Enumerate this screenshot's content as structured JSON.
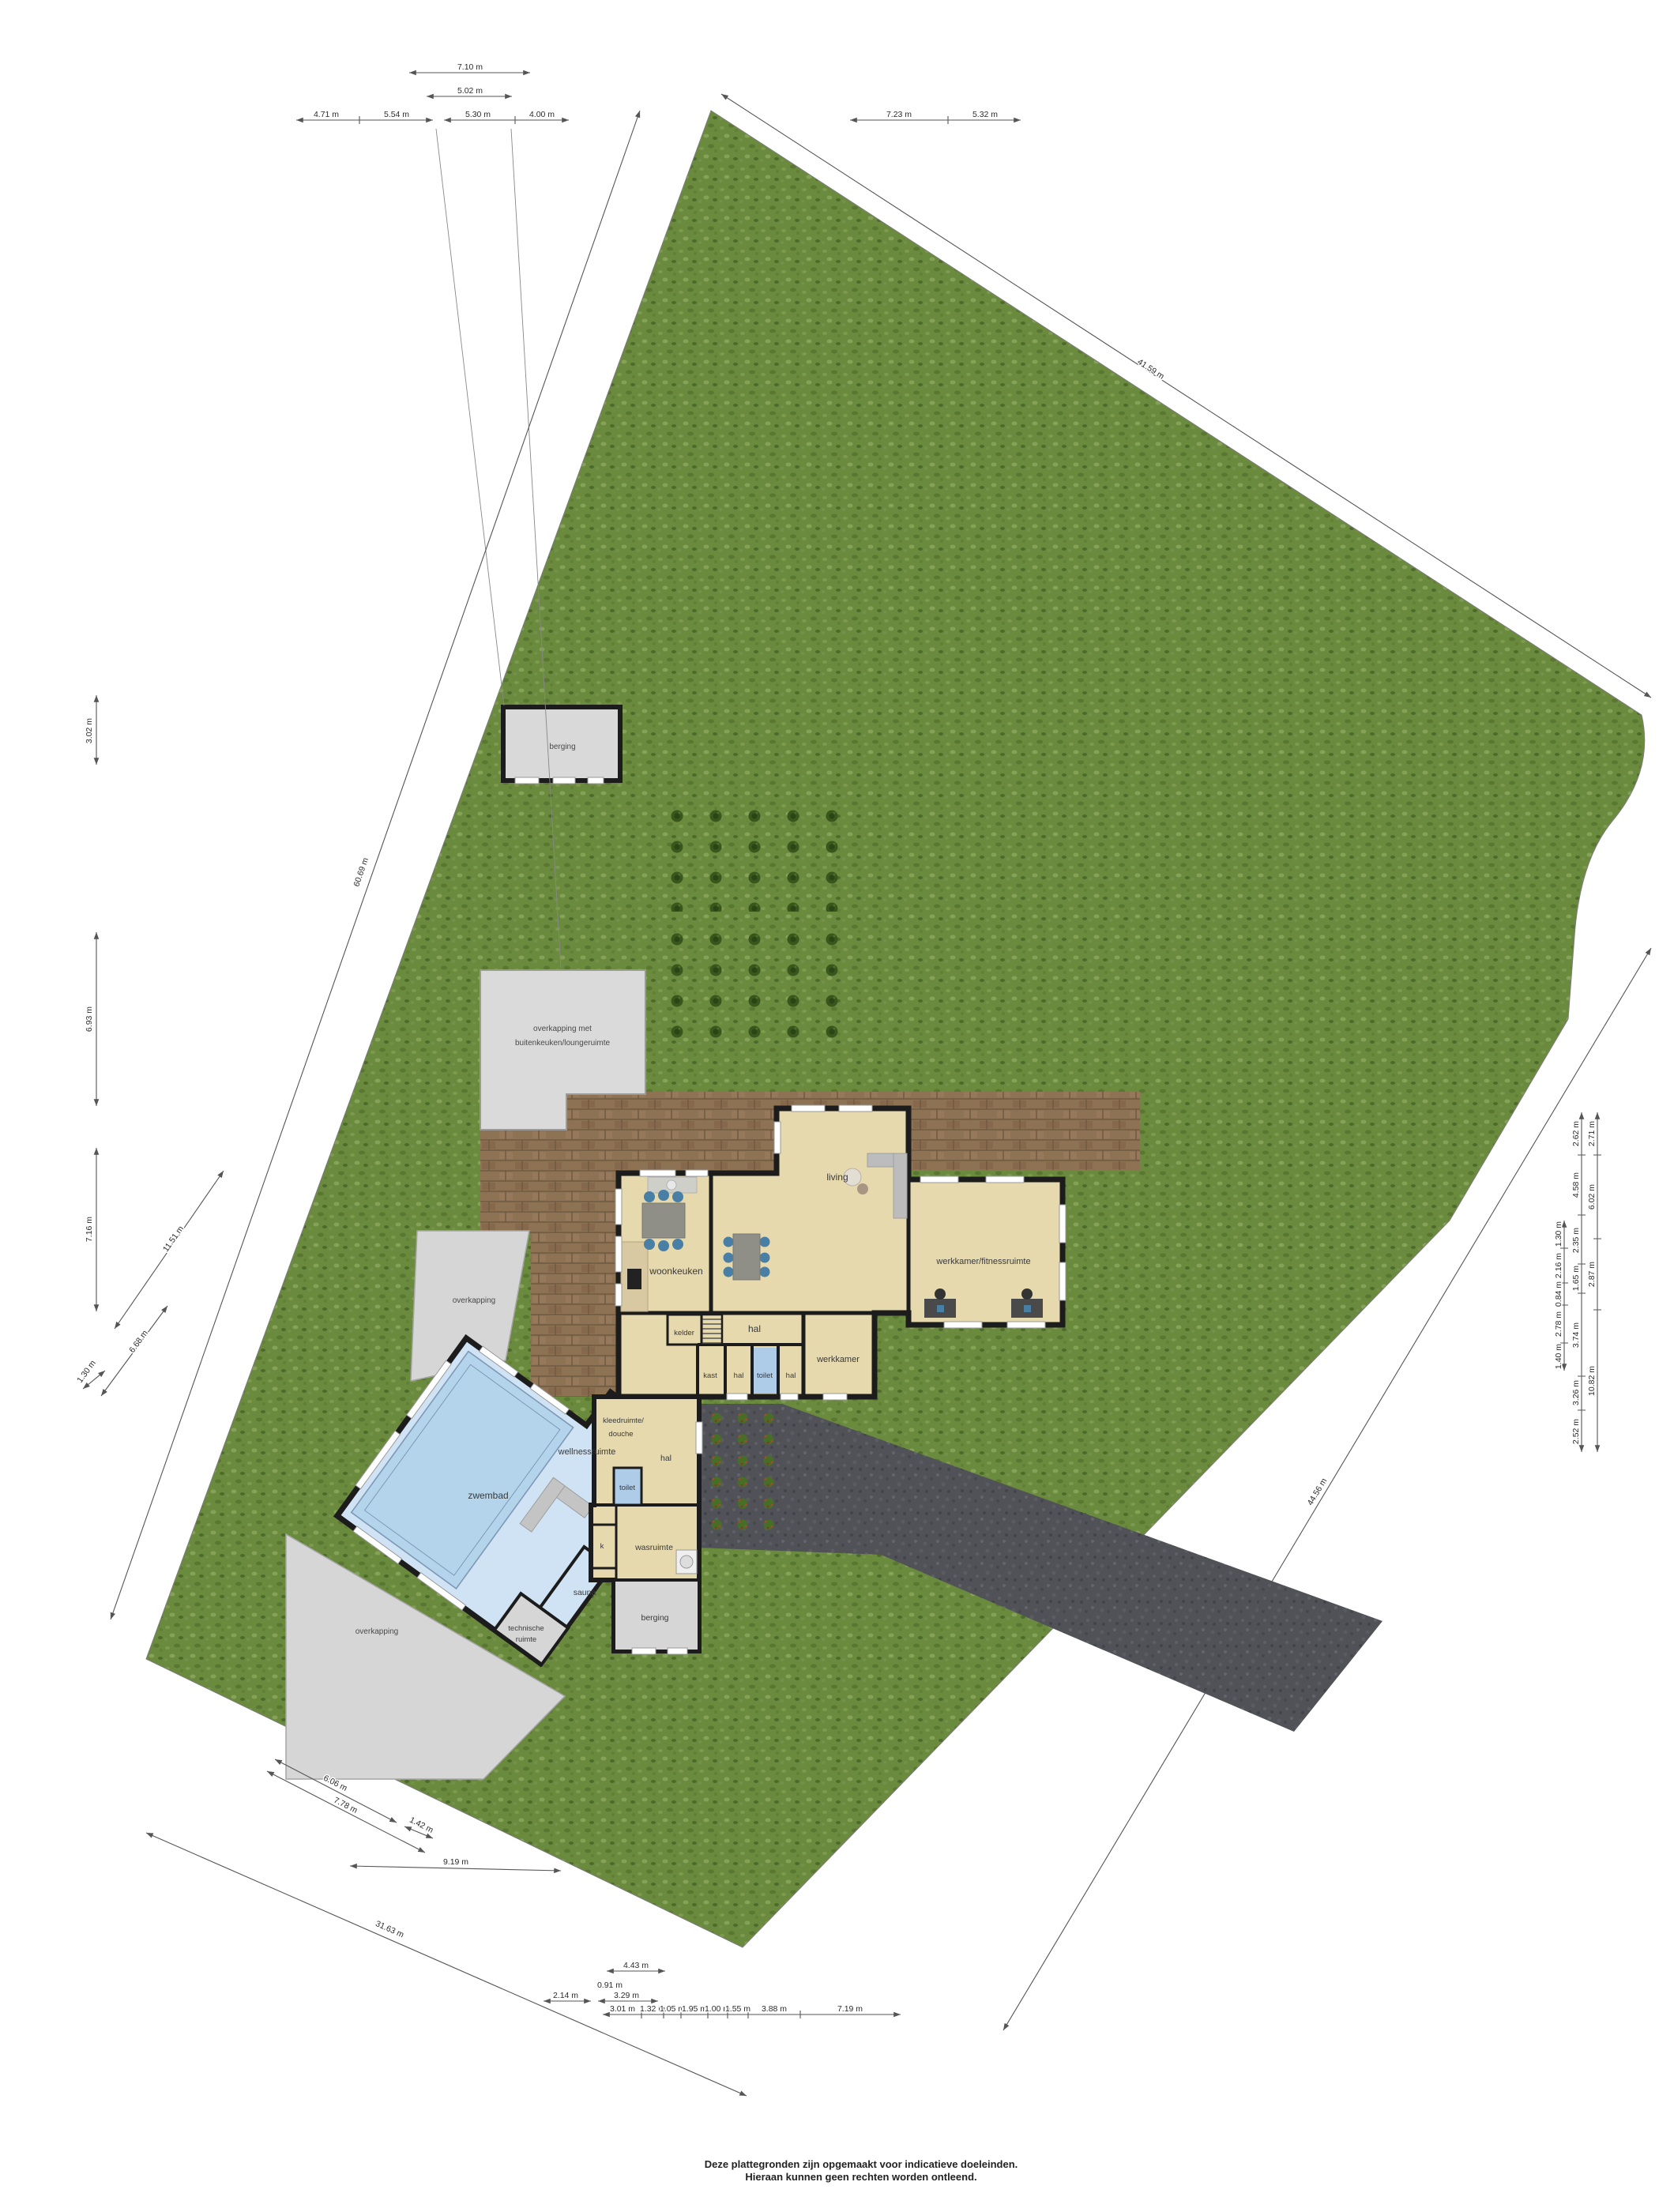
{
  "page": {
    "disclaimer_line1": "Deze plattegronden zijn opgemaakt voor indicatieve doeleinden.",
    "disclaimer_line2": "Hieraan kunnen geen rechten worden ontleend."
  },
  "site": {
    "outbuilding_berging": "berging",
    "overkapping_buitenkeuken_line1": "overkapping met",
    "overkapping_buitenkeuken_line2": "buitenkeuken/loungeruimte",
    "overkapping_left": "overkapping",
    "overkapping_bottom": "overkapping"
  },
  "rooms": {
    "living": "living",
    "woonkeuken": "woonkeuken",
    "werkkamer_fitnessruimte": "werkkamer/fitnessruimte",
    "hal_main": "hal",
    "kelder": "kelder",
    "kast": "kast",
    "hal_small_1": "hal",
    "toilet_main": "toilet",
    "hal_small_2": "hal",
    "werkkamer": "werkkamer",
    "kleedruimte_line1": "kleedruimte/",
    "kleedruimte_line2": "douche",
    "wellnessruimte": "wellnessruimte",
    "zwembad": "zwembad",
    "toilet_pool": "toilet",
    "hal_pool": "hal",
    "kast_k": "k",
    "wasruimte": "wasruimte",
    "sauna": "sauna",
    "berging_pool": "berging",
    "technische_line1": "technische",
    "technische_line2": "ruimte"
  },
  "dimensions": {
    "top_single": [
      "7.10 m",
      "5.02 m"
    ],
    "top_chain": [
      "4.71 m",
      "5.54 m",
      "5.30 m",
      "4.00 m",
      "7.23 m",
      "5.32 m"
    ],
    "left_vertical": [
      "3.02 m",
      "6.93 m",
      "7.16 m"
    ],
    "left_diagonal": [
      "11.51 m",
      "6.68 m",
      "1.30 m",
      "60.69 m"
    ],
    "top_right_diagonal": "41.59 m",
    "right_diagonal": "44.56 m",
    "right_col_inner": [
      "1.30 m",
      "2.16 m",
      "0.84 m",
      "2.78 m",
      "1.40 m"
    ],
    "right_col_mid": [
      "2.62 m",
      "4.58 m",
      "2.35 m",
      "1.65 m",
      "3.74 m",
      "3.26 m",
      "2.52 m"
    ],
    "right_col_outer": [
      "2.71 m",
      "6.02 m",
      "2.87 m",
      "10.82 m"
    ],
    "bottom_small": [
      "4.43 m",
      "0.91 m",
      "2.14 m",
      "3.29 m"
    ],
    "bottom_chain": [
      "3.01 m",
      "1.32 m",
      "1.05 m",
      "1.95 m",
      "1.00 m",
      "1.55 m",
      "3.88 m",
      "7.19 m"
    ],
    "bottom_left_diagonal": [
      "6.06 m",
      "7.78 m",
      "1.42 m",
      "9.19 m",
      "31.63 m"
    ]
  },
  "colors": {
    "grass": "#6a8a3e",
    "terrace": "#8d7254",
    "driveway": "#515257",
    "floor": "#e6d9ae",
    "pool_water": "#b4d4ec",
    "wing_floor": "#cfe3f4",
    "wall": "#1c1c1c",
    "structure_gray": "#d6d6d6",
    "toilet_floor": "#aecbe8"
  }
}
